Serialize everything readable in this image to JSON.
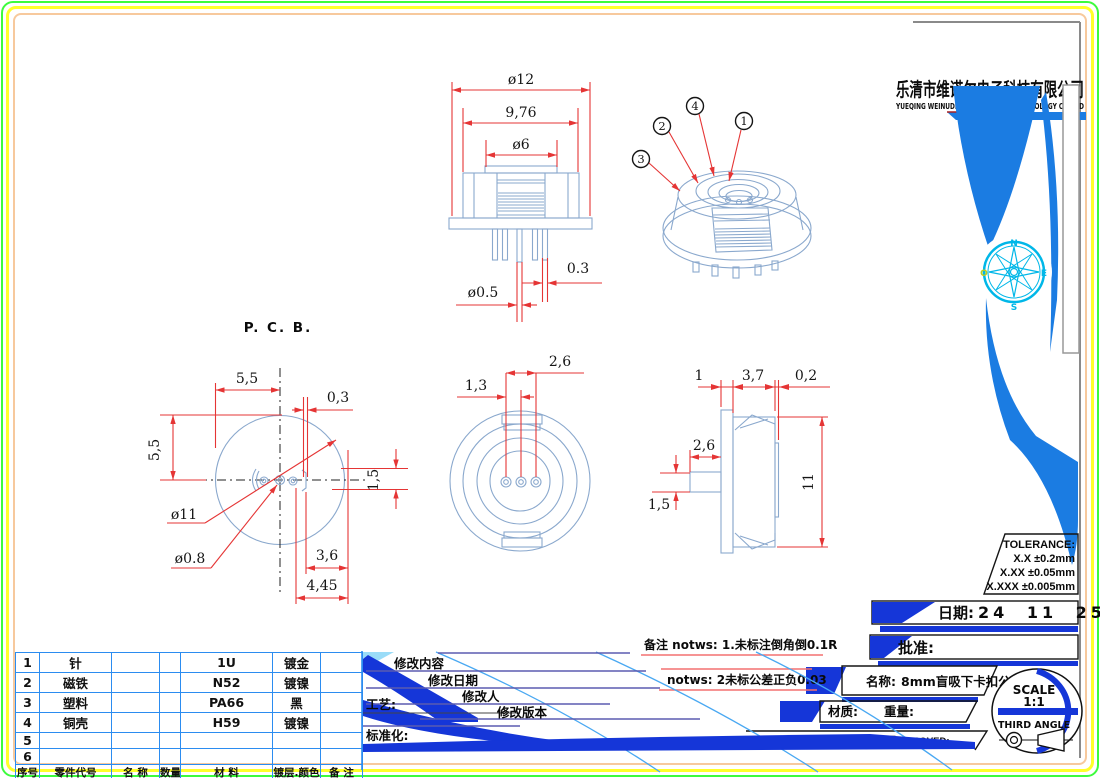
{
  "company": {
    "name_cn": "乐清市维诺尔电子科技有限公司",
    "name_en": "YUEQING WEINUDER ELECTRONICS TECHNOLOGY CO.,LTD"
  },
  "views": {
    "front": {
      "dia_outer": "ø12",
      "width_body": "9,76",
      "dia_cap": "ø6",
      "pin_gap": "0.3",
      "pin_dia": "ø0.5"
    },
    "iso": {
      "balloon_1": "1",
      "balloon_2": "2",
      "balloon_3": "3",
      "balloon_4": "4"
    },
    "pcb": {
      "title": "P. C. B.",
      "offset_x": "5,5",
      "offset_y": "5,5",
      "slot_w": "0,3",
      "slot_h": "1,5",
      "dia_circle": "ø11",
      "dia_hole": "ø0.8",
      "dim_3_6": "3,6",
      "dim_4_45": "4,45"
    },
    "bottom": {
      "pin_span": "2,6",
      "pin_pitch": "1,3"
    },
    "side": {
      "flange_t": "1",
      "body_w": "3,7",
      "clip_t": "0,2",
      "pin_len": "2,6",
      "pin_w": "1,5",
      "height": "11"
    }
  },
  "tolerance": {
    "title": "TOLERANCE:",
    "line1": "X.X  ±0.2mm",
    "line2": "X.XX  ±0.05mm",
    "line3": "X.XXX  ±0.005mm"
  },
  "title_block": {
    "date_label": "日期:",
    "date_value": "24 11 25",
    "approve_label": "批准:",
    "name_label": "名称:",
    "name_value": "8mm盲吸下卡扣公",
    "material_label": "材质:",
    "weight_label": "重量:",
    "drawn": "DRAWN:周海波",
    "checked": "CHECKED:周丕霞",
    "approved": "APPROVED:",
    "scale_label": "SCALE",
    "scale_value": "1:1",
    "angle_label": "THIRD ANGLE"
  },
  "notes": {
    "line1": "备注  notws: 1.未标注倒角倒0.1R",
    "line2": "notws: 2未标公差正负0.03"
  },
  "revision": {
    "content": "修改内容",
    "date": "修改日期",
    "person": "修改人",
    "process": "工艺:",
    "version": "修改版本",
    "standard": "标准化:"
  },
  "compass": {
    "n": "N",
    "e": "E",
    "s": "S",
    "w": "O"
  },
  "parts_table": {
    "rows": [
      [
        "1",
        "针",
        "",
        "",
        "1U",
        "镀金",
        ""
      ],
      [
        "2",
        "磁铁",
        "",
        "",
        "N52",
        "镀镍",
        ""
      ],
      [
        "3",
        "塑料",
        "",
        "",
        "PA66",
        "黑",
        ""
      ],
      [
        "4",
        "铜壳",
        "",
        "",
        "H59",
        "镀镍",
        ""
      ],
      [
        "5",
        "",
        "",
        "",
        "",
        "",
        ""
      ],
      [
        "6",
        "",
        "",
        "",
        "",
        "",
        ""
      ],
      [
        "序号",
        "零件代号",
        "名 称",
        "数量",
        "材 料",
        "镀层.颜色",
        "备 注"
      ]
    ]
  },
  "colors": {
    "dimension_red": "#e53535",
    "line_blue": "#8aa8cd",
    "table_blue": "#2b8cf0",
    "accent_royal": "#1536d8",
    "band_blue": "#1b7ce2",
    "compass_cyan": "#00b7e8",
    "border_green": "#3dfb3d",
    "border_yellow": "#ffff2a",
    "border_peach": "#f7c99d"
  }
}
